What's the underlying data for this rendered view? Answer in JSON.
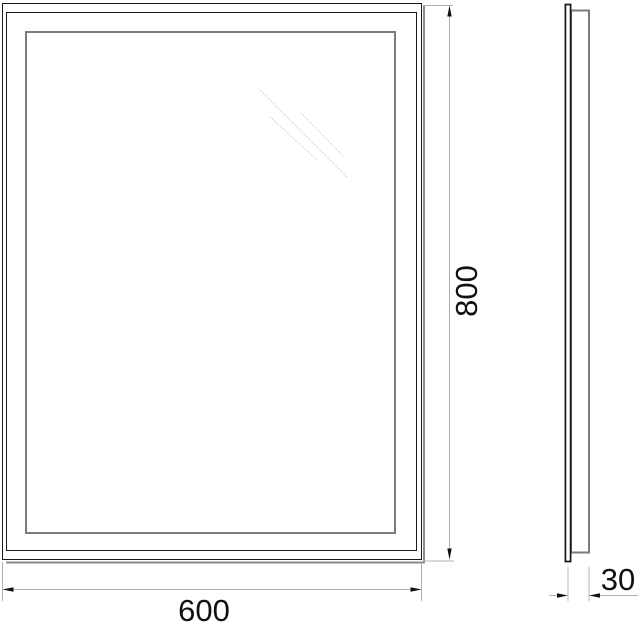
{
  "drawing": {
    "dimensions": {
      "width": "600",
      "height": "800",
      "depth": "30"
    },
    "colors": {
      "outline": "#1a1a1a",
      "frame": "#7b7b7b",
      "shadow": "#8a8a8a",
      "dimension_line": "#b0b0b0",
      "glint": "#bdbdbd",
      "text": "#111111",
      "background": "#ffffff"
    }
  }
}
